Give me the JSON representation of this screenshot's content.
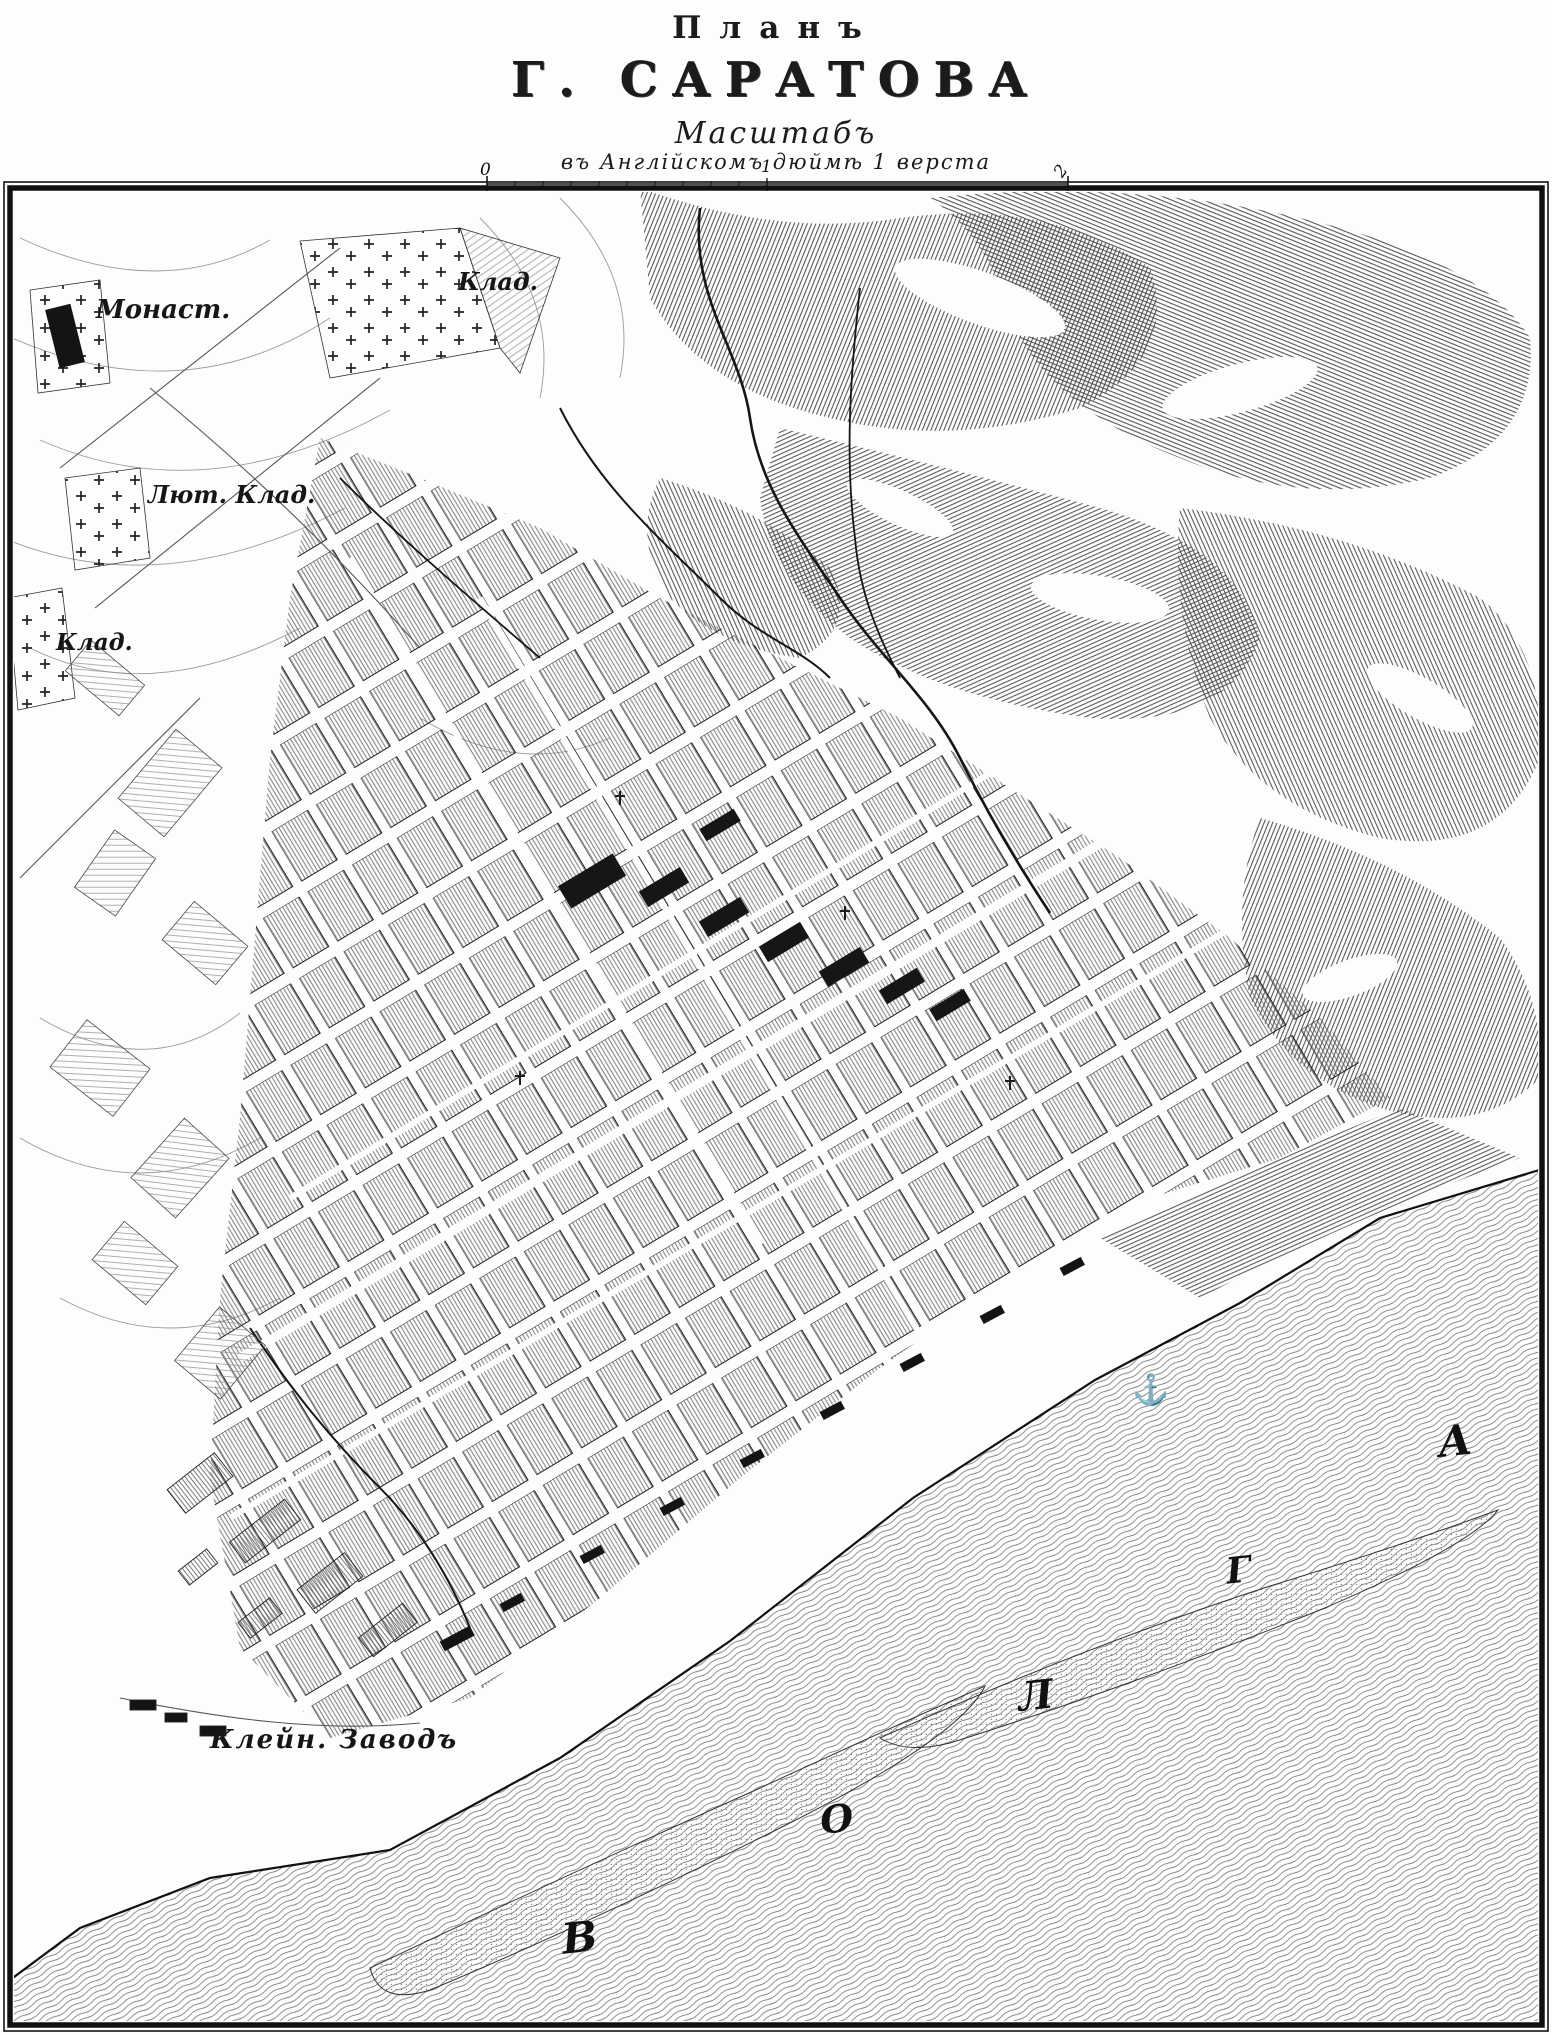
{
  "header": {
    "title_small": "Планъ",
    "title_main": "Г. САРАТОВА",
    "scale_title": "Масштабъ",
    "scale_caption": "въ Англійскомъ дюймѣ 1 верста",
    "scale_bar": {
      "start_label": "0",
      "middle_label": "1",
      "end_label": "2"
    }
  },
  "map": {
    "labels": {
      "monastery": "Монаст.",
      "cemetery_top": "Клад.",
      "lutheran_cemetery": "Лют. Клад.",
      "cemetery_left": "Клад.",
      "factory": "Клейн. Заводъ"
    },
    "river_name_letters": [
      "В",
      "О",
      "Л",
      "Г",
      "А"
    ],
    "anchor_symbol": "⚓"
  },
  "colors": {
    "ink": "#1b1b1b",
    "paper": "#fdfdfb",
    "water_line": "#6d6d6d",
    "hill_line": "#474747"
  }
}
